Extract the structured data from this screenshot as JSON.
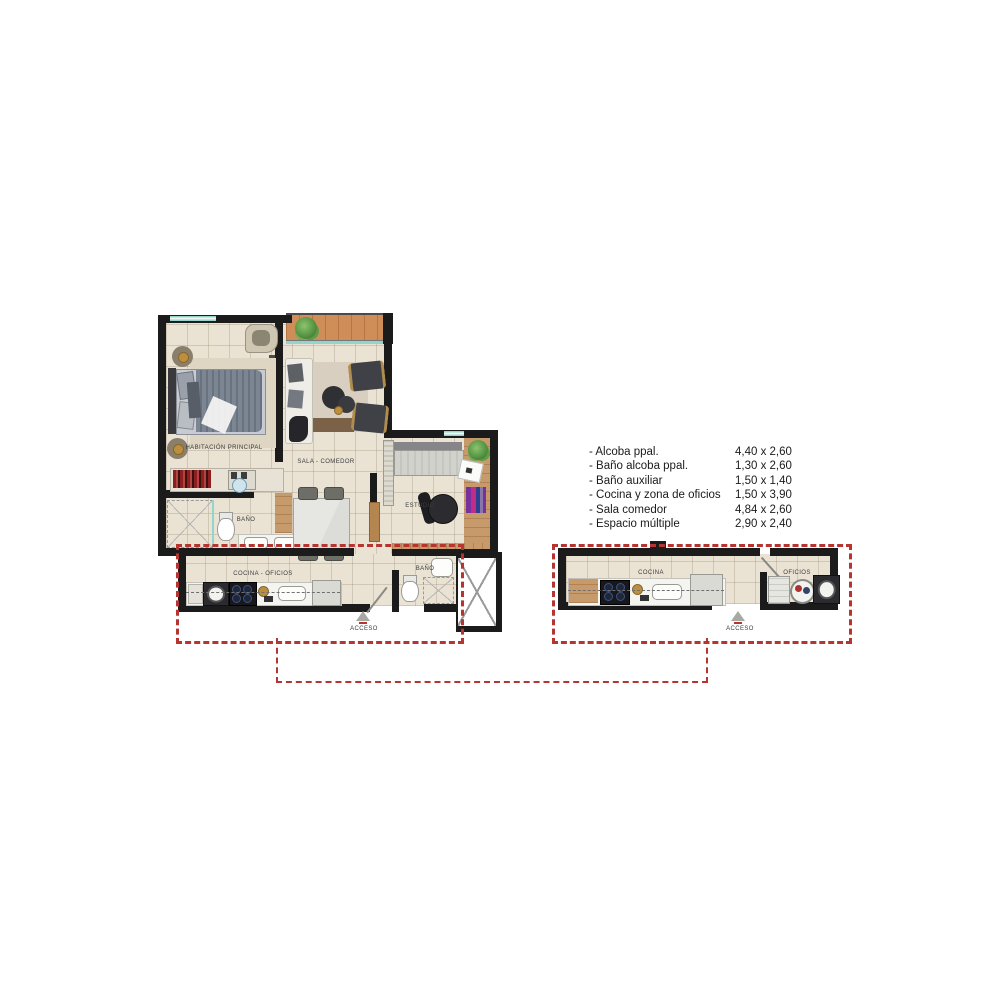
{
  "legend": {
    "items": [
      {
        "name": "- Alcoba ppal.",
        "dims": "4,40 x 2,60"
      },
      {
        "name": "- Baño alcoba ppal.",
        "dims": "1,30 x 2,60"
      },
      {
        "name": "- Baño auxiliar",
        "dims": "1,50 x 1,40"
      },
      {
        "name": "- Cocina y zona de oficios",
        "dims": "1,50 x 3,90"
      },
      {
        "name": "- Sala comedor",
        "dims": "4,84 x 2,60"
      },
      {
        "name": "- Espacio múltiple",
        "dims": "2,90 x 2,40"
      }
    ]
  },
  "main_plan": {
    "labels": {
      "bedroom": "HABITACIÓN PRINCIPAL",
      "living": "SALA - COMEDOR",
      "bath_upper": "BAÑO",
      "study": "ESTUDIO",
      "kitchen": "COCINA - OFICIOS",
      "bath_lower": "BAÑO",
      "access": "ACCESO"
    }
  },
  "detail_plan": {
    "labels": {
      "kitchen": "COCINA",
      "utility": "OFICIOS",
      "access": "ACCESO"
    }
  },
  "colors": {
    "wall": "#1b1b1b",
    "floor": "#eae3d4",
    "wood": "#cf8e57",
    "wood2": "#c69a6b",
    "teal": "#93d4cc",
    "red": "#b63531",
    "text": "#3c3c3c"
  }
}
